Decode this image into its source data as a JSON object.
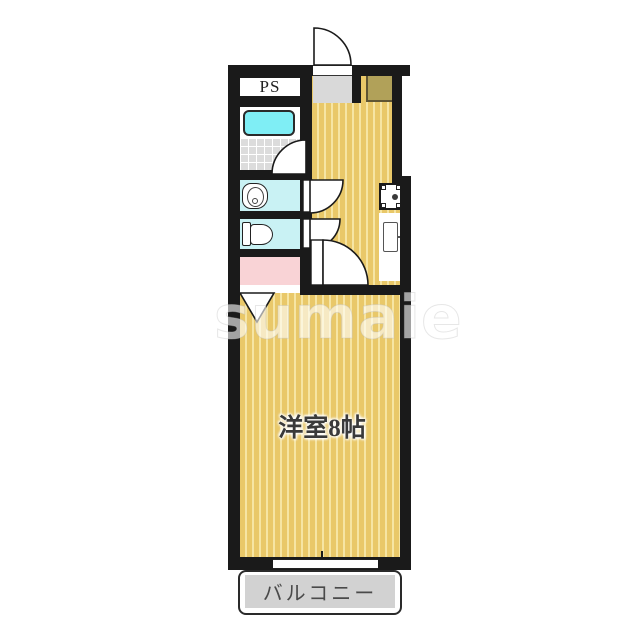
{
  "floorplan": {
    "labels": {
      "pipe_space": "PS",
      "main_room": "洋室8帖",
      "balcony": "バルコニー"
    },
    "watermark": "sumaie",
    "colors": {
      "wall": "#1a1a1a",
      "floor_tan": "#e9c869",
      "floor_stripe": "#f6e5a4",
      "tub_cyan": "#7feef5",
      "sanitary_cyan": "#c9f2f4",
      "laundry_pink": "#f9d3d6",
      "balcony_gray": "#d2d2d2",
      "entry_gray": "#d9d9d9",
      "shoe_cabinet_olive": "#b1a159"
    }
  }
}
